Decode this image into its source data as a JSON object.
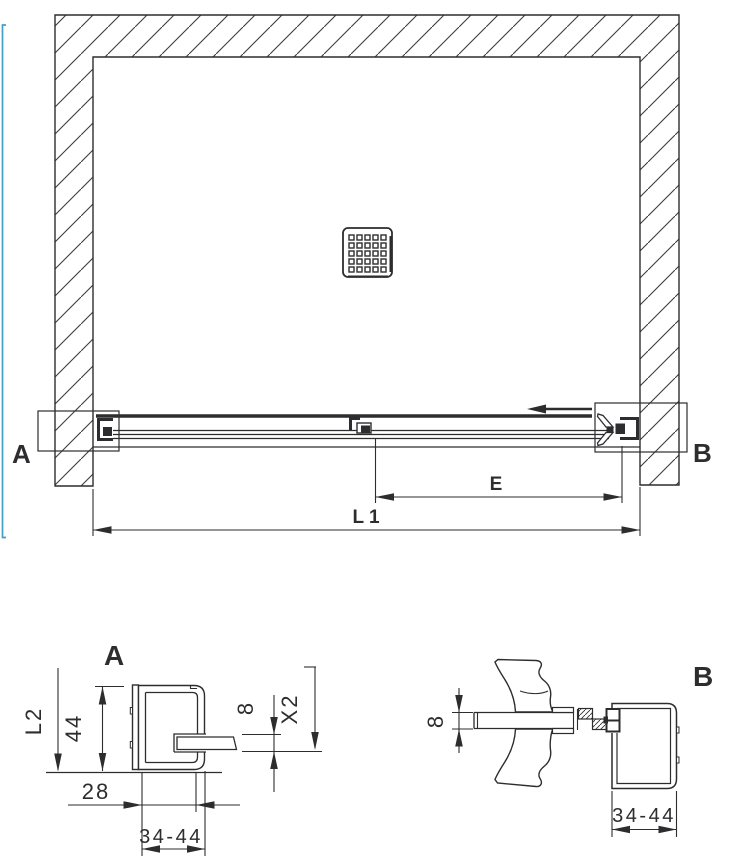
{
  "plan": {
    "marker_a": "A",
    "marker_b": "B",
    "dim_e": "E",
    "dim_l1": "L 1"
  },
  "detail_a": {
    "title": "A",
    "dim_l2": "L2",
    "dim_profile_height": "44",
    "dim_inset": "28",
    "dim_adjust_range": "34-44",
    "dim_glass_thickness": "8",
    "dim_x2": "X2"
  },
  "detail_b": {
    "title": "B",
    "dim_glass_thickness": "8",
    "dim_adjust_range": "34-44"
  },
  "colors": {
    "line": "#2d2d2f",
    "accent_frame": "#42a0c5",
    "background": "#ffffff"
  }
}
